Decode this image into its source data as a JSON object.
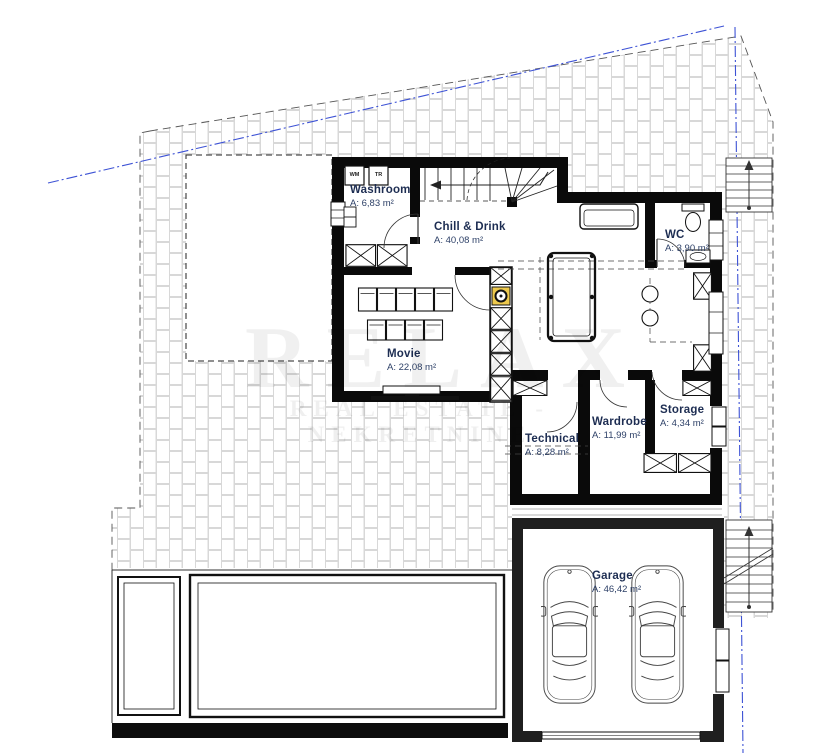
{
  "watermark": {
    "line1": "RELAX",
    "line2": "REAL ESTATE - NEKRETNINE"
  },
  "rooms": {
    "washroom": {
      "name": "Washroom",
      "area": "A: 6,83 m²"
    },
    "chill": {
      "name": "Chill & Drink",
      "area": "A: 40,08 m²"
    },
    "wc": {
      "name": "WC",
      "area": "A: 3,90 m²"
    },
    "movie": {
      "name": "Movie",
      "area": "A: 22,08 m²"
    },
    "technical": {
      "name": "Technical",
      "area": "A: 8,28 m²"
    },
    "wardrobe": {
      "name": "Wardrobe",
      "area": "A: 11,99 m²"
    },
    "storage": {
      "name": "Storage",
      "area": "A: 4,34 m²"
    },
    "garage": {
      "name": "Garage",
      "area": "A: 46,42 m²"
    }
  },
  "appliances": {
    "wm": "WM",
    "tr": "TR"
  },
  "colors": {
    "boundary_blue": "#3d52d5",
    "flue_yellow": "#edc94d",
    "label_navy": "#1d2d52"
  }
}
